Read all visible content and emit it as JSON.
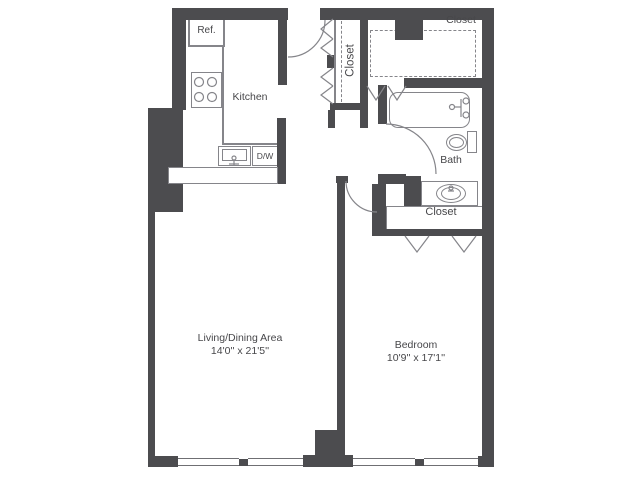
{
  "colors": {
    "wall": "#4c4c4f",
    "line": "#85858a",
    "text": "#47474a"
  },
  "rooms": {
    "kitchen": {
      "label": "Kitchen"
    },
    "living_dining": {
      "label": "Living/Dining Area",
      "dimensions": "14'0'' x 21'5''"
    },
    "bedroom": {
      "label": "Bedroom",
      "dimensions": "10'9'' x 17'1''"
    },
    "bath": {
      "label": "Bath"
    },
    "entry_closet": {
      "label": "Closet"
    },
    "hall_closet": {
      "label": "Closet"
    },
    "bedroom_closet": {
      "label": "Closet"
    }
  },
  "fixtures": {
    "refrigerator": {
      "label": "Ref."
    },
    "dishwasher": {
      "label": "D/W"
    }
  }
}
